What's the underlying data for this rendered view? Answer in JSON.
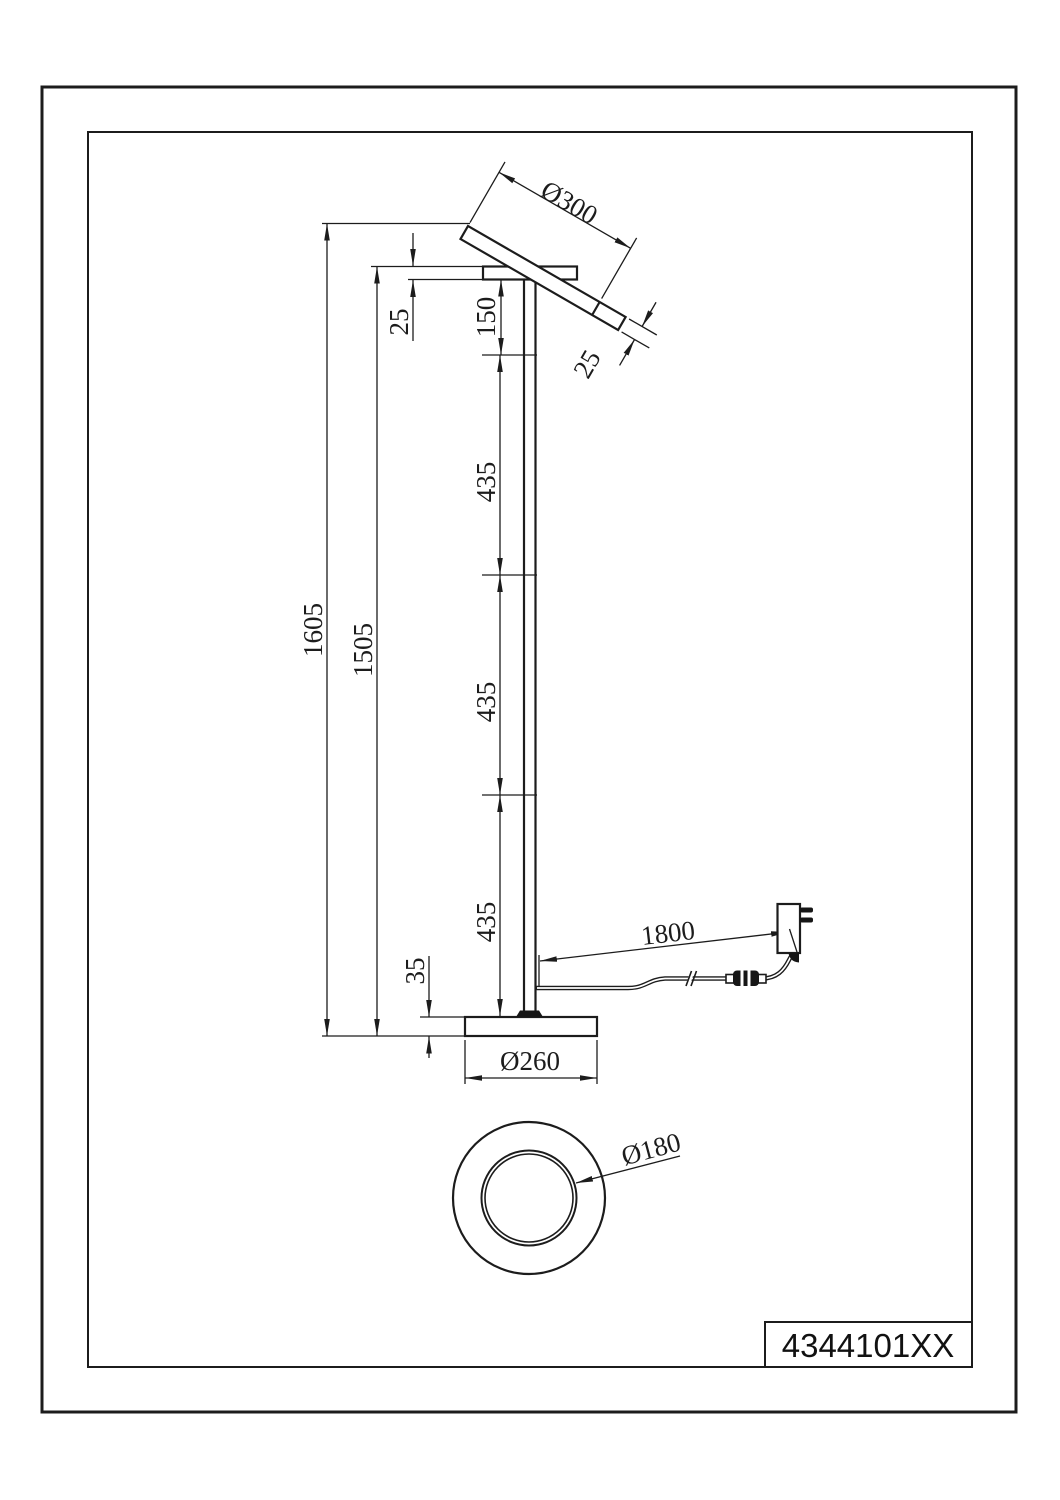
{
  "title_block": {
    "part_number": "4344101XX"
  },
  "dimensions": {
    "head_diameter": "Ø300",
    "head_thickness": "25",
    "arm_thickness": "25",
    "top_segment": "150",
    "segment_1": "435",
    "segment_2": "435",
    "segment_3": "435",
    "overall_height": "1605",
    "arm_height": "1505",
    "base_height": "35",
    "cable_length": "1800",
    "base_diameter": "Ø260",
    "ring_diameter": "Ø180"
  },
  "colors": {
    "line": "#1c1c1c",
    "background": "#ffffff"
  }
}
